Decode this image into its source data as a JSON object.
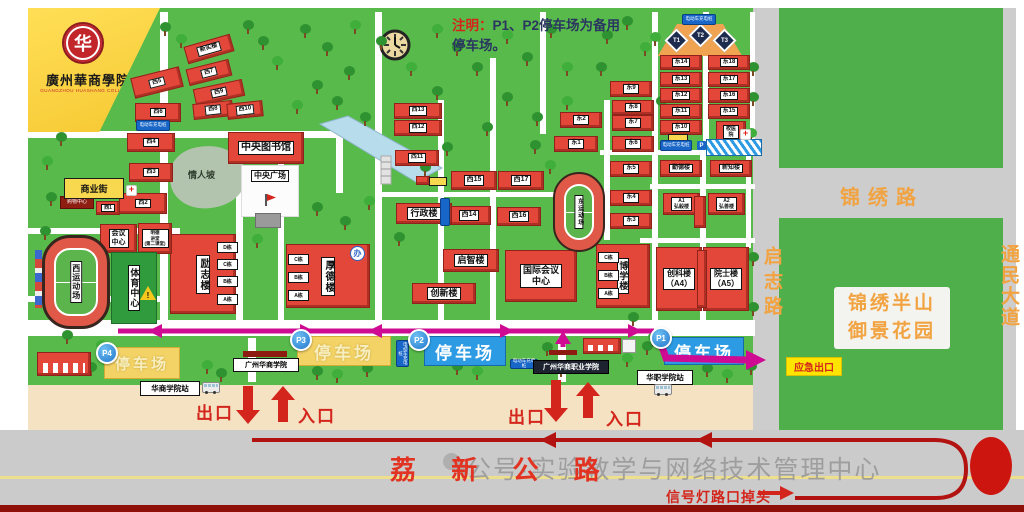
{
  "banner": {
    "seal": "华",
    "college_zh": "廣州華商學院",
    "college_en": "GUANGZHOU HUASHANG COLLEGE"
  },
  "note": {
    "prefix": "注明：",
    "line1": "P1、P2停车场为备用",
    "line2": "停车场。"
  },
  "labels": {
    "exit": "出口",
    "entrance": "入口",
    "emergency": "应急出口",
    "main_gate": "广州华商学院",
    "voc_gate": "广州华商职业学院",
    "station_hs": "华商学院站",
    "station_hz": "华职学院站",
    "charging": "电动车充电桩",
    "p": "P"
  },
  "roads": {
    "lixin": "荔 新 公 路",
    "jinxiu": "锦绣路",
    "qizhi": "启志路",
    "tongmin": "通民大道",
    "uturn": "信号灯路口掉头",
    "estate_line1": "锦绣半山",
    "estate_line2": "御景花园"
  },
  "watermark": {
    "text": "公号·实验教学与网络技术管理中心"
  },
  "map": {
    "places": {
      "west_stadium": "西运动场",
      "east_stadium": "东运动场",
      "sports_center": "体育中心",
      "plaza": "中央广场",
      "lovers_slope": "情人坡",
      "office_icon": "办"
    },
    "courts": [
      "T1",
      "T2",
      "T3"
    ],
    "parking": [
      {
        "id": "P4",
        "label": "停车场",
        "x": 104,
        "y": 347,
        "w": 74,
        "h": 30,
        "bx": 96,
        "by": 342,
        "blue": false,
        "fs": 15
      },
      {
        "id": "P3",
        "label": "停车场",
        "x": 297,
        "y": 336,
        "w": 92,
        "h": 28,
        "bx": 290,
        "by": 329,
        "blue": false,
        "fs": 17
      },
      {
        "id": "P2",
        "label": "停车场",
        "x": 424,
        "y": 336,
        "w": 80,
        "h": 28,
        "bx": 408,
        "by": 329,
        "blue": true,
        "fs": 17
      },
      {
        "id": "P1",
        "label": "停车场",
        "x": 664,
        "y": 337,
        "w": 78,
        "h": 26,
        "bx": 650,
        "by": 327,
        "blue": true,
        "fs": 17
      }
    ],
    "charging_signs": [
      [
        136,
        120,
        32,
        9,
        0
      ],
      [
        682,
        14,
        32,
        9,
        0
      ],
      [
        660,
        140,
        30,
        9,
        0
      ],
      [
        396,
        340,
        11,
        25,
        1
      ],
      [
        510,
        359,
        26,
        8,
        0
      ]
    ],
    "buildings": [
      {
        "label": "新实楼",
        "x": 185,
        "y": 40,
        "w": 46,
        "h": 16,
        "r": -16,
        "fs": 6
      },
      {
        "label": "西7",
        "x": 187,
        "y": 64,
        "w": 42,
        "h": 15,
        "r": -14,
        "fs": 6
      },
      {
        "label": "西9",
        "x": 194,
        "y": 84,
        "w": 48,
        "h": 15,
        "r": -12,
        "fs": 6
      },
      {
        "label": "西5",
        "x": 132,
        "y": 72,
        "w": 48,
        "h": 19,
        "r": -14,
        "fs": 6
      },
      {
        "label": "西8",
        "x": 193,
        "y": 102,
        "w": 38,
        "h": 14,
        "r": -6,
        "fs": 6
      },
      {
        "label": "西10",
        "x": 227,
        "y": 102,
        "w": 34,
        "h": 14,
        "r": -6,
        "fs": 6
      },
      {
        "label": "西6",
        "x": 135,
        "y": 103,
        "w": 44,
        "h": 17,
        "fs": 6
      },
      {
        "label": "西4",
        "x": 127,
        "y": 133,
        "w": 46,
        "h": 17,
        "fs": 6
      },
      {
        "label": "西3",
        "x": 129,
        "y": 163,
        "w": 42,
        "h": 17,
        "fs": 6
      },
      {
        "label": "西2",
        "x": 119,
        "y": 193,
        "w": 46,
        "h": 19,
        "fs": 6
      },
      {
        "label": "西1",
        "x": 96,
        "y": 201,
        "w": 22,
        "h": 12,
        "fs": 5
      },
      {
        "label": "购物中心",
        "x": 60,
        "y": 196,
        "w": 32,
        "h": 11,
        "t": "maroon",
        "fs": 5
      },
      {
        "label": "商业街",
        "x": 64,
        "y": 178,
        "w": 58,
        "h": 19,
        "t": "yellow",
        "fs": 9
      },
      {
        "label": "中央图书馆",
        "x": 228,
        "y": 132,
        "w": 74,
        "h": 30,
        "fs": 10
      },
      {
        "label": "西13",
        "x": 394,
        "y": 103,
        "w": 46,
        "h": 14,
        "fs": 6
      },
      {
        "label": "西12",
        "x": 394,
        "y": 120,
        "w": 46,
        "h": 14,
        "fs": 6
      },
      {
        "label": "西11",
        "x": 395,
        "y": 150,
        "w": 42,
        "h": 14,
        "fs": 6
      },
      {
        "label": "西15",
        "x": 451,
        "y": 171,
        "w": 44,
        "h": 17,
        "fs": 7
      },
      {
        "label": "西17",
        "x": 498,
        "y": 171,
        "w": 44,
        "h": 17,
        "fs": 7
      },
      {
        "label": "西14",
        "x": 447,
        "y": 206,
        "w": 42,
        "h": 17,
        "fs": 7
      },
      {
        "label": "西16",
        "x": 497,
        "y": 207,
        "w": 42,
        "h": 17,
        "fs": 7
      },
      {
        "label": "行政楼",
        "x": 396,
        "y": 203,
        "w": 54,
        "h": 19,
        "fs": 9
      },
      {
        "label": "启智楼",
        "x": 443,
        "y": 249,
        "w": 54,
        "h": 21,
        "fs": 9
      },
      {
        "label": "创新楼",
        "x": 412,
        "y": 283,
        "w": 62,
        "h": 19,
        "fs": 9
      },
      {
        "label": "国际会议\n中心",
        "x": 505,
        "y": 250,
        "w": 70,
        "h": 50,
        "fs": 9
      },
      {
        "label": "博学楼",
        "x": 596,
        "y": 244,
        "w": 52,
        "h": 62,
        "v": 1,
        "fs": 9
      },
      {
        "label": "C栋",
        "x": 598,
        "y": 252,
        "w": 15,
        "h": 9,
        "t": "tag",
        "fs": 5
      },
      {
        "label": "B栋",
        "x": 598,
        "y": 270,
        "w": 15,
        "h": 9,
        "t": "tag",
        "fs": 5
      },
      {
        "label": "A栋",
        "x": 598,
        "y": 288,
        "w": 15,
        "h": 9,
        "t": "tag",
        "fs": 5
      },
      {
        "label": "厚德楼",
        "x": 286,
        "y": 244,
        "w": 82,
        "h": 62,
        "v": 1,
        "fs": 10
      },
      {
        "label": "C栋",
        "x": 288,
        "y": 254,
        "w": 15,
        "h": 9,
        "t": "tag",
        "fs": 5
      },
      {
        "label": "B栋",
        "x": 288,
        "y": 272,
        "w": 15,
        "h": 9,
        "t": "tag",
        "fs": 5
      },
      {
        "label": "A栋",
        "x": 288,
        "y": 290,
        "w": 15,
        "h": 9,
        "t": "tag",
        "fs": 5
      },
      {
        "label": "励志楼",
        "x": 170,
        "y": 234,
        "w": 64,
        "h": 78,
        "v": 1,
        "fs": 10
      },
      {
        "label": "D栋",
        "x": 217,
        "y": 242,
        "w": 15,
        "h": 9,
        "t": "tag",
        "fs": 5
      },
      {
        "label": "C栋",
        "x": 217,
        "y": 259,
        "w": 15,
        "h": 9,
        "t": "tag",
        "fs": 5
      },
      {
        "label": "B栋",
        "x": 217,
        "y": 276,
        "w": 15,
        "h": 9,
        "t": "tag",
        "fs": 5
      },
      {
        "label": "A栋",
        "x": 217,
        "y": 294,
        "w": 15,
        "h": 9,
        "t": "tag",
        "fs": 5
      },
      {
        "label": "会议\n中心",
        "x": 100,
        "y": 224,
        "w": 35,
        "h": 27,
        "fs": 7
      },
      {
        "label": "明德\n讲堂\n(第二课堂)",
        "x": 138,
        "y": 223,
        "w": 32,
        "h": 29,
        "fs": 4.5
      },
      {
        "label": "东1",
        "x": 554,
        "y": 136,
        "w": 42,
        "h": 14,
        "fs": 6
      },
      {
        "label": "东2",
        "x": 560,
        "y": 112,
        "w": 40,
        "h": 14,
        "fs": 6
      },
      {
        "label": "东3",
        "x": 610,
        "y": 213,
        "w": 40,
        "h": 14,
        "fs": 6
      },
      {
        "label": "东4",
        "x": 610,
        "y": 190,
        "w": 40,
        "h": 14,
        "fs": 6
      },
      {
        "label": "东5",
        "x": 610,
        "y": 161,
        "w": 40,
        "h": 14,
        "fs": 6
      },
      {
        "label": "东6",
        "x": 612,
        "y": 136,
        "w": 40,
        "h": 14,
        "fs": 6
      },
      {
        "label": "东7",
        "x": 612,
        "y": 115,
        "w": 40,
        "h": 14,
        "fs": 6
      },
      {
        "label": "东8",
        "x": 612,
        "y": 100,
        "w": 40,
        "h": 13,
        "fs": 6
      },
      {
        "label": "东9",
        "x": 610,
        "y": 81,
        "w": 40,
        "h": 14,
        "fs": 6
      },
      {
        "label": "东10",
        "x": 660,
        "y": 120,
        "w": 40,
        "h": 13,
        "fs": 6
      },
      {
        "label": "东11",
        "x": 660,
        "y": 104,
        "w": 40,
        "h": 13,
        "fs": 6
      },
      {
        "label": "东12",
        "x": 660,
        "y": 88,
        "w": 40,
        "h": 13,
        "fs": 6
      },
      {
        "label": "东13",
        "x": 660,
        "y": 72,
        "w": 40,
        "h": 13,
        "fs": 6
      },
      {
        "label": "东14",
        "x": 660,
        "y": 55,
        "w": 40,
        "h": 13,
        "fs": 6
      },
      {
        "label": "东15",
        "x": 708,
        "y": 104,
        "w": 40,
        "h": 13,
        "fs": 6
      },
      {
        "label": "东16",
        "x": 708,
        "y": 88,
        "w": 40,
        "h": 13,
        "fs": 6
      },
      {
        "label": "东17",
        "x": 708,
        "y": 72,
        "w": 40,
        "h": 13,
        "fs": 6
      },
      {
        "label": "东18",
        "x": 708,
        "y": 55,
        "w": 40,
        "h": 13,
        "fs": 6
      },
      {
        "label": "校医\n院",
        "x": 716,
        "y": 121,
        "w": 28,
        "h": 19,
        "fs": 5
      },
      {
        "label": "勤德楼",
        "x": 660,
        "y": 160,
        "w": 40,
        "h": 15,
        "fs": 6
      },
      {
        "label": "新知楼",
        "x": 710,
        "y": 160,
        "w": 40,
        "h": 15,
        "fs": 6
      },
      {
        "label": "A1\n弘毅楼",
        "x": 663,
        "y": 193,
        "w": 35,
        "h": 20,
        "fs": 5
      },
      {
        "label": "A2\n弘善楼",
        "x": 708,
        "y": 193,
        "w": 35,
        "h": 20,
        "fs": 5
      },
      {
        "label": "",
        "x": 694,
        "y": 196,
        "w": 10,
        "h": 30
      },
      {
        "label": "创科楼\n（A4）",
        "x": 656,
        "y": 247,
        "w": 44,
        "h": 62,
        "fs": 8
      },
      {
        "label": "院士楼\n（A5）",
        "x": 703,
        "y": 247,
        "w": 44,
        "h": 62,
        "fs": 8
      },
      {
        "label": "",
        "x": 697,
        "y": 250,
        "w": 8,
        "h": 56
      },
      {
        "label": "",
        "x": 37,
        "y": 352,
        "w": 52,
        "h": 22,
        "t": "doors"
      },
      {
        "label": "",
        "x": 583,
        "y": 338,
        "w": 36,
        "h": 14,
        "t": "doors"
      },
      {
        "label": "",
        "x": 622,
        "y": 339,
        "w": 12,
        "h": 12,
        "t": "white"
      },
      {
        "label": "",
        "x": 416,
        "y": 176,
        "w": 12,
        "h": 7
      },
      {
        "label": "",
        "x": 429,
        "y": 177,
        "w": 16,
        "h": 7,
        "t": "yellow"
      },
      {
        "label": "",
        "x": 668,
        "y": 134,
        "w": 18,
        "h": 6,
        "t": "yellow"
      },
      {
        "label": "",
        "x": 440,
        "y": 198,
        "w": 8,
        "h": 26,
        "t": "bluesign"
      }
    ]
  },
  "colors": {
    "campus_green": "#58ba4a",
    "route_magenta": "#ce0b92",
    "road_red": "#b31310",
    "label_orange": "#f2a341",
    "parking_yellow": "#f3d366",
    "parking_blue": "#2d9be4"
  }
}
